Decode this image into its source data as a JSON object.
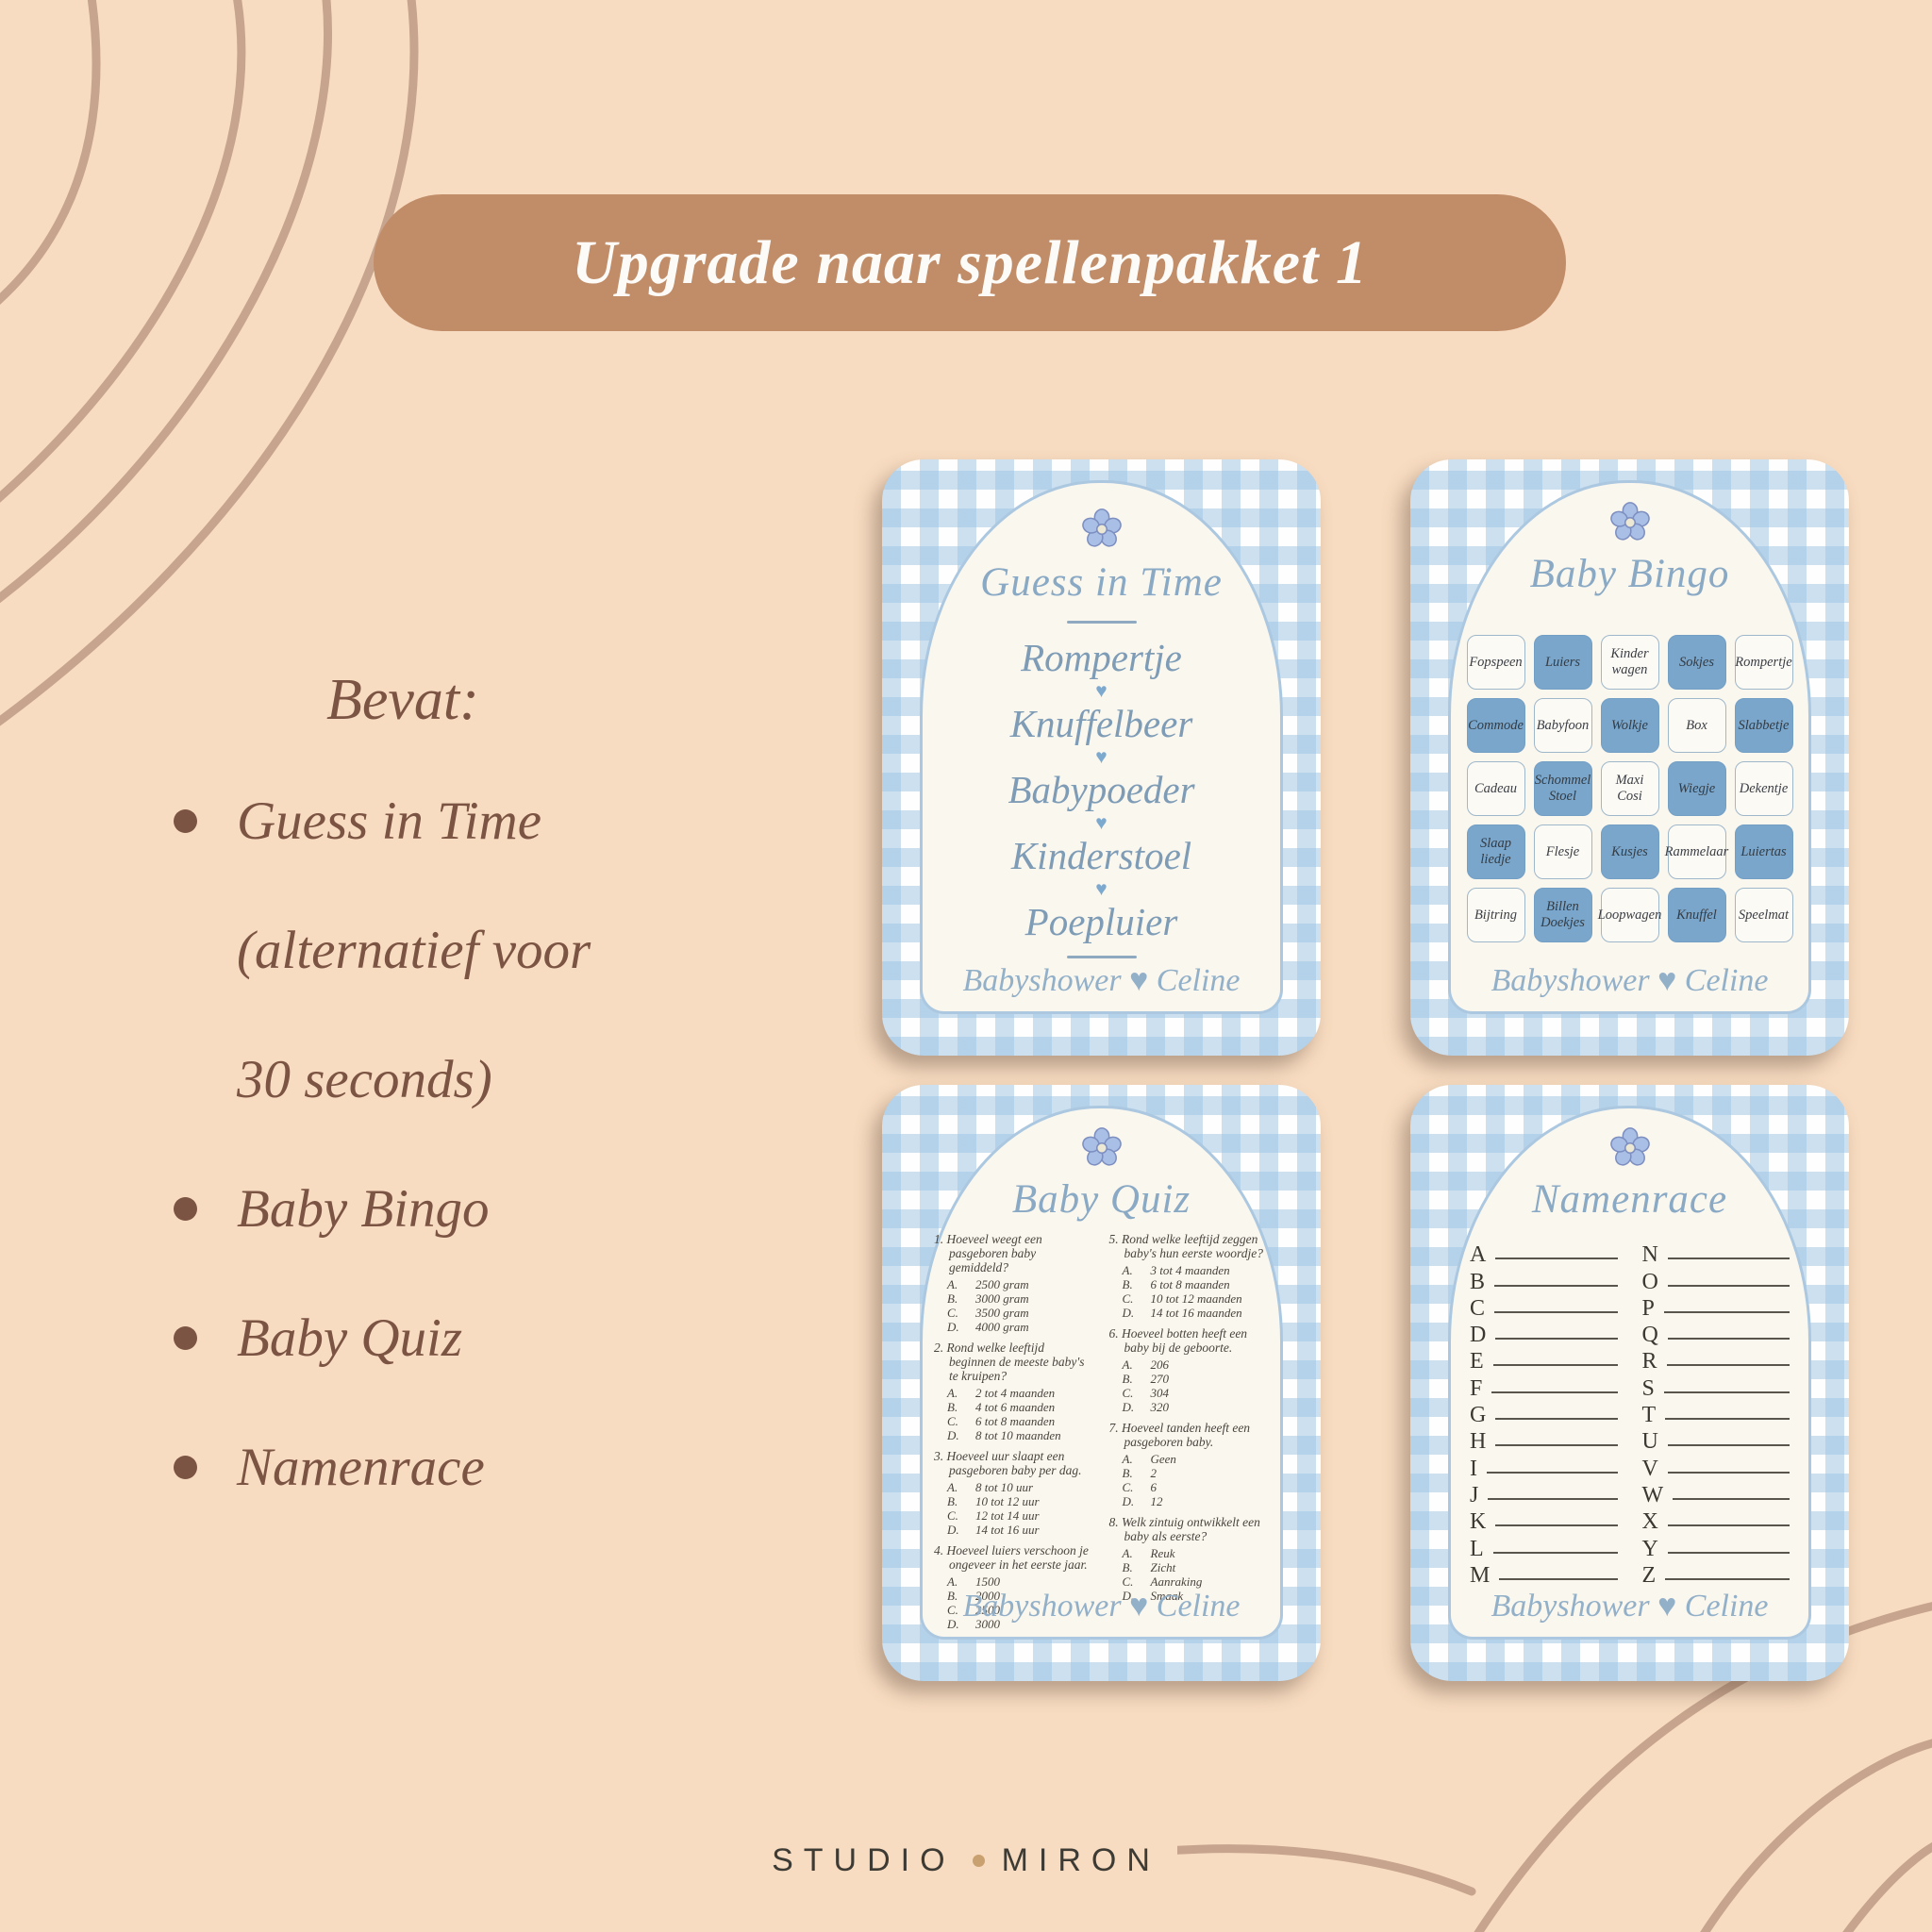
{
  "banner": {
    "label": "Upgrade naar spellenpakket 1"
  },
  "left_panel": {
    "heading": "Bevat:",
    "bullets": [
      {
        "text": "Guess in Time\n(alternatief voor\n30 seconds)"
      },
      {
        "text": "Baby Bingo"
      },
      {
        "text": "Baby Quiz"
      },
      {
        "text": "Namenrace"
      }
    ]
  },
  "ui": {
    "heart": "♥"
  },
  "cards": {
    "guess_in_time": {
      "title": "Guess in Time",
      "words": [
        "Rompertje",
        "Knuffelbeer",
        "Babypoeder",
        "Kinderstoel",
        "Poepluier"
      ],
      "footer": "Babyshower ♥ Celine"
    },
    "baby_bingo": {
      "title": "Baby Bingo",
      "cells": [
        "Fopspeen",
        "Luiers",
        "Kinder\nwagen",
        "Sokjes",
        "Rompertje",
        "Commode",
        "Babyfoon",
        "Wolkje",
        "Box",
        "Slabbetje",
        "Cadeau",
        "Schommel\nStoel",
        "Maxi\nCosi",
        "Wiegje",
        "Dekentje",
        "Slaap\nliedje",
        "Flesje",
        "Kusjes",
        "Rammelaar",
        "Luiertas",
        "Bijtring",
        "Billen\nDoekjes",
        "Loopwagen",
        "Knuffel",
        "Speelmat"
      ],
      "footer": "Babyshower ♥ Celine"
    },
    "baby_quiz": {
      "title": "Baby Quiz",
      "col1": [
        {
          "q": "1. Hoeveel weegt een pasgeboren baby gemiddeld?",
          "options": [
            [
              "A.",
              "2500 gram"
            ],
            [
              "B.",
              "3000 gram"
            ],
            [
              "C.",
              "3500 gram"
            ],
            [
              "D.",
              "4000 gram"
            ]
          ]
        },
        {
          "q": "2. Rond welke leeftijd beginnen de meeste baby's te kruipen?",
          "options": [
            [
              "A.",
              "2 tot 4 maanden"
            ],
            [
              "B.",
              "4 tot 6 maanden"
            ],
            [
              "C.",
              "6 tot 8 maanden"
            ],
            [
              "D.",
              "8 tot 10 maanden"
            ]
          ]
        },
        {
          "q": "3. Hoeveel uur slaapt een pasgeboren baby per dag.",
          "options": [
            [
              "A.",
              "8 tot 10 uur"
            ],
            [
              "B.",
              "10 tot 12 uur"
            ],
            [
              "C.",
              "12 tot 14 uur"
            ],
            [
              "D.",
              "14 tot 16 uur"
            ]
          ]
        },
        {
          "q": "4. Hoeveel luiers verschoon je ongeveer in het eerste jaar.",
          "options": [
            [
              "A.",
              "1500"
            ],
            [
              "B.",
              "2000"
            ],
            [
              "C.",
              "2500"
            ],
            [
              "D.",
              "3000"
            ]
          ]
        }
      ],
      "col2": [
        {
          "q": "5. Rond welke leeftijd zeggen baby's hun eerste woordje?",
          "options": [
            [
              "A.",
              "3 tot 4 maanden"
            ],
            [
              "B.",
              "6 tot 8 maanden"
            ],
            [
              "C.",
              "10 tot 12 maanden"
            ],
            [
              "D.",
              "14 tot 16 maanden"
            ]
          ]
        },
        {
          "q": "6. Hoeveel botten heeft een baby bij de geboorte.",
          "options": [
            [
              "A.",
              "206"
            ],
            [
              "B.",
              "270"
            ],
            [
              "C.",
              "304"
            ],
            [
              "D.",
              "320"
            ]
          ]
        },
        {
          "q": "7. Hoeveel tanden heeft een pasgeboren baby.",
          "options": [
            [
              "A.",
              "Geen"
            ],
            [
              "B.",
              "2"
            ],
            [
              "C.",
              "6"
            ],
            [
              "D.",
              "12"
            ]
          ]
        },
        {
          "q": "8. Welk zintuig ontwikkelt een baby als eerste?",
          "options": [
            [
              "A.",
              "Reuk"
            ],
            [
              "B.",
              "Zicht"
            ],
            [
              "C.",
              "Aanraking"
            ],
            [
              "D.",
              "Smaak"
            ]
          ]
        }
      ],
      "footer": "Babyshower ♥ Celine"
    },
    "namenrace": {
      "title": "Namenrace",
      "letters1": [
        "A",
        "B",
        "C",
        "D",
        "E",
        "F",
        "G",
        "H",
        "I",
        "J",
        "K",
        "L",
        "M"
      ],
      "letters2": [
        "N",
        "O",
        "P",
        "Q",
        "R",
        "S",
        "T",
        "U",
        "V",
        "W",
        "X",
        "Y",
        "Z"
      ],
      "footer": "Babyshower ♥ Celine"
    }
  },
  "brand": {
    "left": "STUDIO",
    "right": "MIRON"
  },
  "colors": {
    "background": "#F8DCC1",
    "banner_bg": "#C18C68",
    "banner_text": "#FDFBF7",
    "text_brown": "#7C5443",
    "gingham_blue": "#BFD9EC",
    "panel_cream": "#FAF7EF",
    "panel_border": "#ABC8E0",
    "bingo_blue": "#7AA6CB",
    "title_blue": "#8AA9C4",
    "footer_blue": "#93B0C9",
    "squiggle": "#C6A48D",
    "brand_dot": "#C9A06F",
    "brand_text": "#3E3B35"
  }
}
